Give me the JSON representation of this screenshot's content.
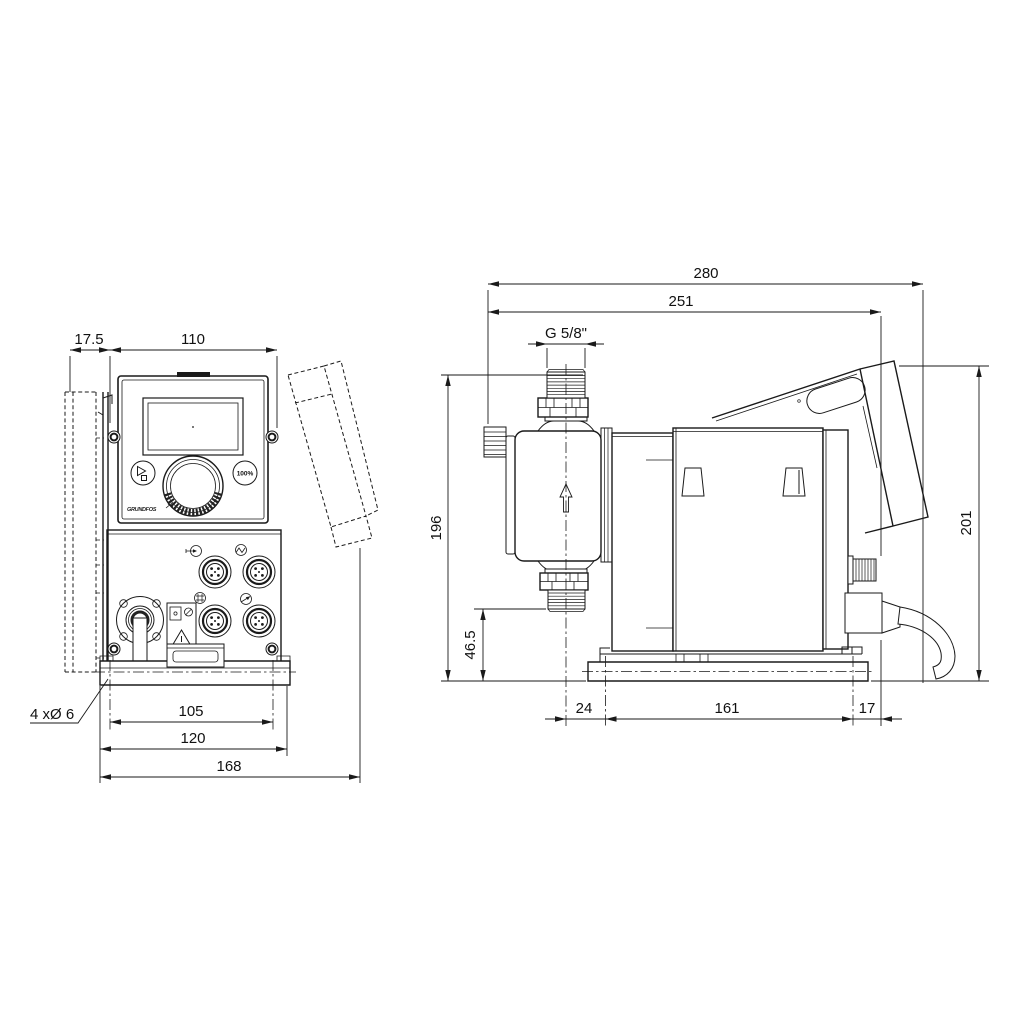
{
  "drawing_type": "pump dimensional drawing",
  "front_view": {
    "dims": {
      "offset": "17.5",
      "panel_width": "110",
      "hole_pitch": "105",
      "base_width": "120",
      "total_width": "168",
      "holes": "4 xØ 6"
    },
    "panel": {
      "brand": "GRUNDFOS",
      "capacity_button": "100%"
    }
  },
  "side_view": {
    "dims": {
      "total_depth": "280",
      "body_depth": "251",
      "connection_thread": "G 5/8\"",
      "height_connection": "196",
      "height_valve": "46.5",
      "total_height": "201",
      "front_offset": "24",
      "hole_pitch": "161",
      "rear_offset": "17"
    }
  }
}
